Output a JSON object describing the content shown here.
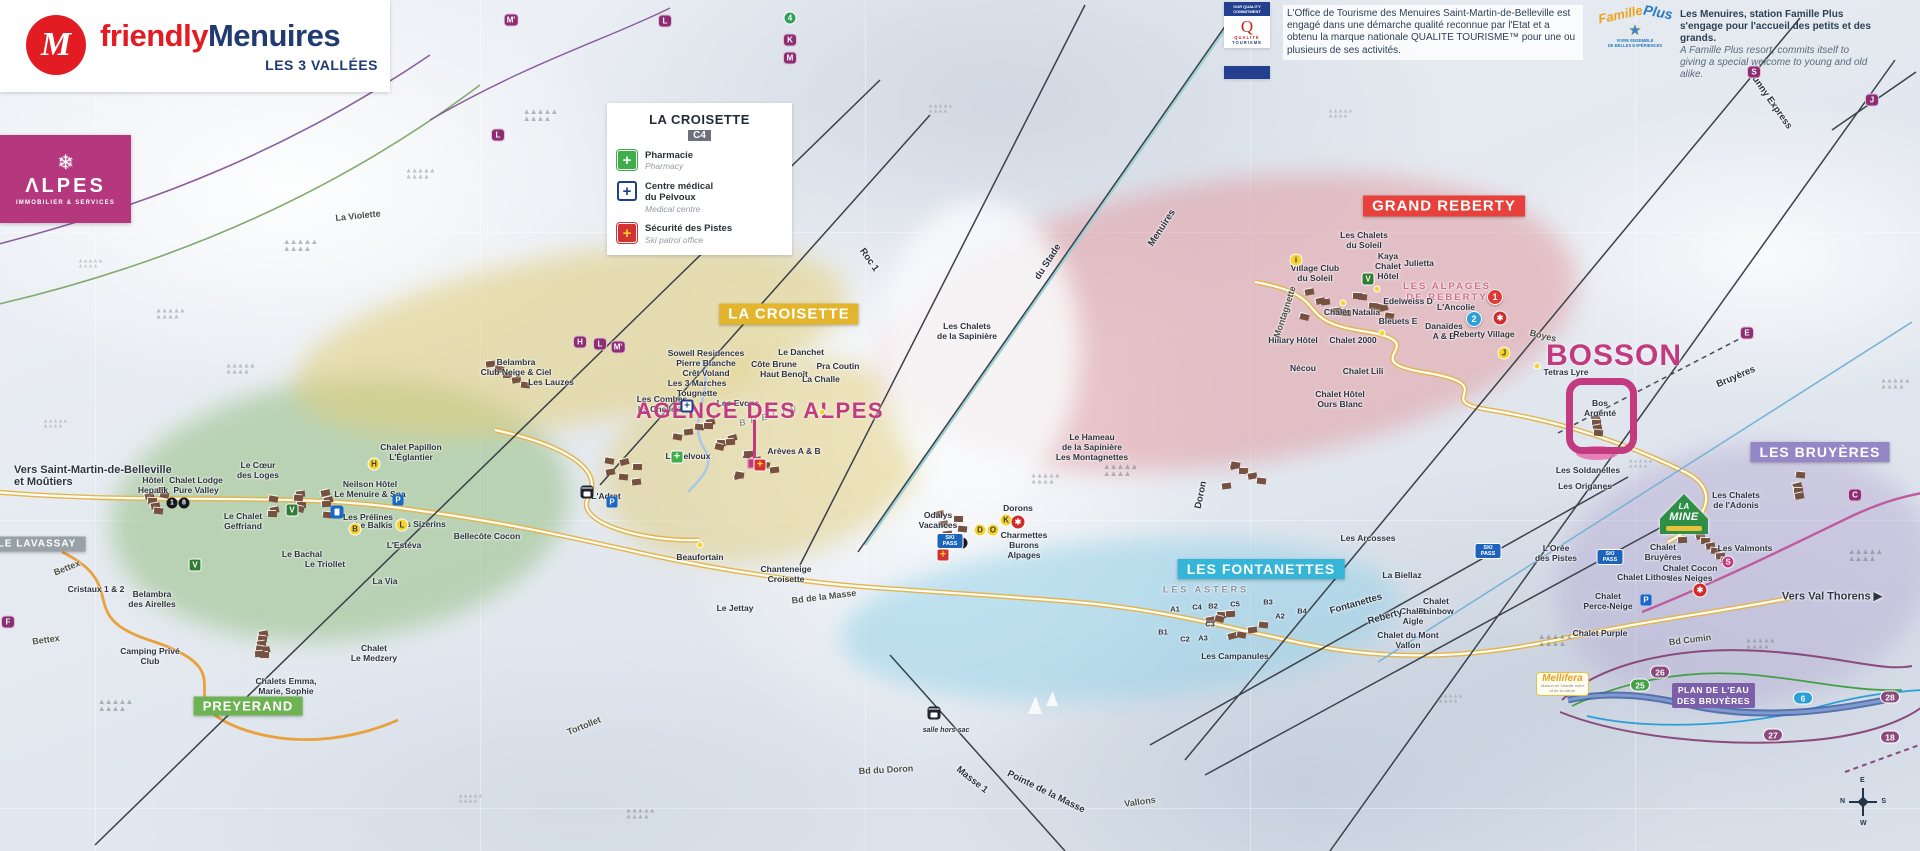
{
  "branding": {
    "monogram": "M",
    "name_a": "friendly",
    "name_b": "Menuires",
    "subtitle": "LES 3 VALLÉES",
    "alpes_flake": "❄",
    "alpes_title": "ΛLPES",
    "alpes_subtitle": "IMMOBILIER & SERVICES"
  },
  "legend": {
    "title": "LA CROISETTE",
    "code": "C4",
    "items": [
      {
        "type": "pharmacy-cross",
        "glyph": "+",
        "fr": "Pharmacie",
        "en": "Pharmacy"
      },
      {
        "type": "medical-cross",
        "glyph": "+",
        "fr": "Centre médical\ndu Pelvoux",
        "en": "Medical centre"
      },
      {
        "type": "patrol-cross",
        "glyph": "+",
        "fr": "Sécurité des Pistes",
        "en": "Ski patrol office"
      }
    ]
  },
  "quality_tourisme": {
    "banner": "OUR QUALITY COMMITMENT",
    "q": "Q",
    "brand1": "QUALITÉ",
    "brand2": "TOURISME",
    "text": "L'Office de Tourisme des Menuires Saint-Martin-de-Belleville est engagé dans une démarche qualité reconnue par l'Etat et a obtenu la marque nationale QUALITE TOURISME™ pour une ou plusieurs de ses activités."
  },
  "famille_plus": {
    "brand_a": "Famille",
    "brand_b": "Plus",
    "star": "★",
    "sub": "VIVRE ENSEMBLE\nDE BELLES EXPÉRIENCES",
    "text_fr": "Les Menuires, station Famille Plus s'engage pour l'accueil des petits et des grands.",
    "text_en": "A Famille Plus resort, commits itself to giving a special welcome to young and old alike."
  },
  "map": {
    "banners": [
      {
        "id": "croisette",
        "label": "LA CROISETTE",
        "color": "#e2b52d",
        "x": 789,
        "y": 314,
        "s": 15
      },
      {
        "id": "grand-reberty",
        "label": "GRAND REBERTY",
        "color": "#e8403a",
        "x": 1444,
        "y": 206,
        "s": 15
      },
      {
        "id": "fontanettes",
        "label": "LES FONTANETTES",
        "color": "#35b6d9",
        "x": 1261,
        "y": 569,
        "s": 14
      },
      {
        "id": "bruyeres",
        "label": "LES BRUYÈRES",
        "color": "#9387c5",
        "x": 1820,
        "y": 452,
        "s": 14
      },
      {
        "id": "preyerand",
        "label": "PREYERAND",
        "color": "#6db354",
        "x": 248,
        "y": 706,
        "s": 13
      },
      {
        "id": "lavassay",
        "label": "LE LAVASSAY",
        "color": "#99a1a8",
        "x": 37,
        "y": 544,
        "s": 10
      }
    ],
    "big_labels": [
      {
        "id": "bosson",
        "label": "BOSSON",
        "x": 1614,
        "y": 356,
        "size": 30,
        "ls": 1
      },
      {
        "id": "agence-des-alpes",
        "label": "AGENCE DES ALPES",
        "x": 760,
        "y": 411,
        "size": 22,
        "ls": 1.5
      }
    ],
    "directions": [
      {
        "t": "Vers Saint-Martin-de-Belleville\net Moûtiers",
        "x": 14,
        "y": 476,
        "a": "left"
      },
      {
        "t": "Vers Val Thorens ▶",
        "x": 1832,
        "y": 596
      }
    ],
    "places": [
      {
        "t": "Sowell Residences\nPierre Blanche\nCrêt Voland",
        "x": 706,
        "y": 363
      },
      {
        "t": "Les 3 Marches\nTougnette",
        "x": 697,
        "y": 388
      },
      {
        "t": "Les Combes\nLa Chellerie",
        "x": 662,
        "y": 404
      },
      {
        "t": "Les Evons",
        "x": 738,
        "y": 403
      },
      {
        "t": "Le Danchet",
        "x": 801,
        "y": 352
      },
      {
        "t": "Côte Brune",
        "x": 774,
        "y": 364
      },
      {
        "t": "Haut Benoît",
        "x": 784,
        "y": 374
      },
      {
        "t": "Pra Coutin",
        "x": 838,
        "y": 366
      },
      {
        "t": "La Challe",
        "x": 821,
        "y": 379
      },
      {
        "t": "Belambra\nClub Neige & Ciel",
        "x": 516,
        "y": 367
      },
      {
        "t": "Les Lauzes",
        "x": 551,
        "y": 382
      },
      {
        "t": "Chalet Papillon\nL'Églantier",
        "x": 411,
        "y": 452
      },
      {
        "t": "Neilson Hôtel\nLe Menuire & Spa",
        "x": 370,
        "y": 489
      },
      {
        "t": "Les Sizerins",
        "x": 421,
        "y": 524
      },
      {
        "t": "Bellecôte Cocon",
        "x": 487,
        "y": 536
      },
      {
        "t": "L'Adret",
        "x": 606,
        "y": 496
      },
      {
        "t": "Le Pelvoux",
        "x": 688,
        "y": 456
      },
      {
        "t": "Arèves A & B",
        "x": 794,
        "y": 451
      },
      {
        "t": "Beaufortain",
        "x": 700,
        "y": 557
      },
      {
        "t": "Le Jettay",
        "x": 735,
        "y": 608
      },
      {
        "t": "Chanteneige\nCroisette",
        "x": 786,
        "y": 574
      },
      {
        "t": "Odalys\nVacances",
        "x": 938,
        "y": 520
      },
      {
        "t": "Dorons",
        "x": 1018,
        "y": 508
      },
      {
        "t": "Charmettes\nBurons\nAlpages",
        "x": 1024,
        "y": 545
      },
      {
        "t": "Le Hameau\nde la Sapinière\nLes Montagnettes",
        "x": 1092,
        "y": 447
      },
      {
        "t": "Les Chalets\nde la Sapinière",
        "x": 967,
        "y": 331
      },
      {
        "t": "Les Chalets\ndu Soleil",
        "x": 1364,
        "y": 240
      },
      {
        "t": "Village Club\ndu Soleil",
        "x": 1315,
        "y": 273
      },
      {
        "t": "Kaya\nChalet\nHôtel",
        "x": 1388,
        "y": 266
      },
      {
        "t": "Julietta",
        "x": 1419,
        "y": 263
      },
      {
        "t": "LES ALPAGES\nDE REBERTY",
        "x": 1447,
        "y": 292,
        "c": "#d66a8e",
        "sp": 2,
        "s": 9.5
      },
      {
        "t": "Edelweiss D",
        "x": 1408,
        "y": 301
      },
      {
        "t": "L'Ancolie",
        "x": 1456,
        "y": 307
      },
      {
        "t": "Chalet Natalia",
        "x": 1352,
        "y": 312
      },
      {
        "t": "Bleuets E",
        "x": 1398,
        "y": 321
      },
      {
        "t": "Danaïdes\nA & B",
        "x": 1444,
        "y": 331
      },
      {
        "t": "Reberty Village",
        "x": 1484,
        "y": 334
      },
      {
        "t": "Chalet 2000",
        "x": 1353,
        "y": 340
      },
      {
        "t": "Hillary Hôtel",
        "x": 1293,
        "y": 340
      },
      {
        "t": "Chalet Lili",
        "x": 1363,
        "y": 371
      },
      {
        "t": "Nécou",
        "x": 1303,
        "y": 368
      },
      {
        "t": "Chalet Hôtel\nOurs Blanc",
        "x": 1340,
        "y": 399
      },
      {
        "t": "Les Soldanelles",
        "x": 1588,
        "y": 470
      },
      {
        "t": "Les Origanes",
        "x": 1585,
        "y": 486
      },
      {
        "t": "Tetras Lyre",
        "x": 1566,
        "y": 372
      },
      {
        "t": "Bos\nArgenté",
        "x": 1600,
        "y": 408
      },
      {
        "t": "Les Chalets\nde l'Adonis",
        "x": 1736,
        "y": 500
      },
      {
        "t": "Les Valmonts",
        "x": 1745,
        "y": 548
      },
      {
        "t": "Chalet\nBruyères",
        "x": 1663,
        "y": 552
      },
      {
        "t": "Chalet Cocon\ndes Neiges",
        "x": 1690,
        "y": 573
      },
      {
        "t": "Chalet Lithos",
        "x": 1644,
        "y": 577
      },
      {
        "t": "La Biellaz",
        "x": 1402,
        "y": 575
      },
      {
        "t": "Les Arcosses",
        "x": 1368,
        "y": 538
      },
      {
        "t": "Chalet\nRainbow",
        "x": 1436,
        "y": 606
      },
      {
        "t": "Chalet\nAigle",
        "x": 1413,
        "y": 616
      },
      {
        "t": "Chalet du Mont\nVallon",
        "x": 1408,
        "y": 640
      },
      {
        "t": "Chalet\nPerce-Neige",
        "x": 1608,
        "y": 601
      },
      {
        "t": "Chalet Purple",
        "x": 1600,
        "y": 633
      },
      {
        "t": "L'Orée\ndes Pistes",
        "x": 1556,
        "y": 553
      },
      {
        "t": "LES ASTERS",
        "x": 1206,
        "y": 590,
        "c": "#8a93a1",
        "sp": 3,
        "s": 9
      },
      {
        "t": "A1",
        "x": 1175,
        "y": 610,
        "s": 7.5
      },
      {
        "t": "C4",
        "x": 1197,
        "y": 608,
        "s": 7.5
      },
      {
        "t": "B2",
        "x": 1213,
        "y": 607,
        "s": 7.5
      },
      {
        "t": "C5",
        "x": 1235,
        "y": 605,
        "s": 7.5
      },
      {
        "t": "B3",
        "x": 1268,
        "y": 603,
        "s": 7.5
      },
      {
        "t": "A2",
        "x": 1280,
        "y": 617,
        "s": 7.5
      },
      {
        "t": "B4",
        "x": 1302,
        "y": 612,
        "s": 7.5
      },
      {
        "t": "C3",
        "x": 1210,
        "y": 625,
        "s": 7.5
      },
      {
        "t": "B1",
        "x": 1163,
        "y": 633,
        "s": 7.5
      },
      {
        "t": "C2",
        "x": 1185,
        "y": 640,
        "s": 7.5
      },
      {
        "t": "A3",
        "x": 1203,
        "y": 639,
        "s": 7.5
      },
      {
        "t": "Les Campanules",
        "x": 1235,
        "y": 656
      },
      {
        "t": "Le Cœur\ndes Loges",
        "x": 258,
        "y": 470
      },
      {
        "t": "Hôtel\nHepalik",
        "x": 153,
        "y": 485
      },
      {
        "t": "Chalet Lodge\nPure Valley",
        "x": 196,
        "y": 485
      },
      {
        "t": "Le Chalet\nGeffriand",
        "x": 243,
        "y": 521
      },
      {
        "t": "Le Bachal",
        "x": 302,
        "y": 554
      },
      {
        "t": "Le Triollet",
        "x": 325,
        "y": 564
      },
      {
        "t": "La Via",
        "x": 385,
        "y": 581
      },
      {
        "t": "Les Prélines",
        "x": 368,
        "y": 517
      },
      {
        "t": "Le Balkis",
        "x": 374,
        "y": 525
      },
      {
        "t": "L'Estéva",
        "x": 404,
        "y": 545
      },
      {
        "t": "Belambra\ndes Airelles",
        "x": 152,
        "y": 599
      },
      {
        "t": "Cristaux 1 & 2",
        "x": 96,
        "y": 589
      },
      {
        "t": "Camping Privé\nClub",
        "x": 150,
        "y": 656
      },
      {
        "t": "Chalet\nLe Medzery",
        "x": 374,
        "y": 653
      },
      {
        "t": "Chalets Emma,\nMarie, Sophie\n& Alice",
        "x": 286,
        "y": 691
      },
      {
        "t": "salle hors-sac",
        "x": 946,
        "y": 731,
        "s": 7,
        "i": 1
      }
    ],
    "lifts": [
      {
        "t": "Menuires",
        "x": 1162,
        "y": 228,
        "r": -57
      },
      {
        "t": "du Stade",
        "x": 1048,
        "y": 262,
        "r": -57
      },
      {
        "t": "Roc 1",
        "x": 869,
        "y": 260,
        "r": 55
      },
      {
        "t": "Sunny Express",
        "x": 1770,
        "y": 100,
        "r": 55
      },
      {
        "t": "Bruyères",
        "x": 1736,
        "y": 377,
        "r": -23
      },
      {
        "t": "Fontanettes",
        "x": 1356,
        "y": 604,
        "r": -16
      },
      {
        "t": "Reberty",
        "x": 1385,
        "y": 617,
        "r": -16
      },
      {
        "t": "Masse 1",
        "x": 972,
        "y": 780,
        "r": 38
      },
      {
        "t": "Pointe de la Masse",
        "x": 1046,
        "y": 792,
        "r": 26
      },
      {
        "t": "Doron",
        "x": 1201,
        "y": 495,
        "r": -78
      }
    ],
    "roads": [
      {
        "t": "La Violette",
        "x": 358,
        "y": 216,
        "r": -6
      },
      {
        "t": "Bettex",
        "x": 67,
        "y": 568,
        "r": -22
      },
      {
        "t": "Bettex",
        "x": 46,
        "y": 640,
        "r": -8
      },
      {
        "t": "BRELIN",
        "x": 770,
        "y": 416,
        "r": -14,
        "sp": 5,
        "c": "#8f9384",
        "i": 1
      },
      {
        "t": "Montagnette",
        "x": 1285,
        "y": 312,
        "r": -72
      },
      {
        "t": "Boyes",
        "x": 1543,
        "y": 336,
        "r": 14
      },
      {
        "t": "Bd de la Masse",
        "x": 824,
        "y": 597,
        "r": -7
      },
      {
        "t": "Tortollet",
        "x": 584,
        "y": 726,
        "r": -22
      },
      {
        "t": "Bd du Doron",
        "x": 886,
        "y": 770,
        "r": -3
      },
      {
        "t": "Vallons",
        "x": 1140,
        "y": 802,
        "r": -8
      },
      {
        "t": "Bd Cumin",
        "x": 1690,
        "y": 640,
        "r": -7
      }
    ],
    "badges": [
      {
        "k": "pill",
        "t": "M'",
        "x": 511,
        "y": 20
      },
      {
        "k": "pill",
        "t": "L",
        "x": 665,
        "y": 21
      },
      {
        "k": "gcircle",
        "t": "4",
        "x": 790,
        "y": 18
      },
      {
        "k": "pill",
        "t": "K",
        "x": 790,
        "y": 40
      },
      {
        "k": "pill",
        "t": "M",
        "x": 790,
        "y": 58
      },
      {
        "k": "pill",
        "t": "L",
        "x": 498,
        "y": 135
      },
      {
        "k": "pill",
        "t": "H",
        "x": 580,
        "y": 342
      },
      {
        "k": "pill",
        "t": "L",
        "x": 600,
        "y": 344
      },
      {
        "k": "pill",
        "t": "M'",
        "x": 618,
        "y": 347
      },
      {
        "k": "pill",
        "t": "E",
        "x": 1747,
        "y": 333
      },
      {
        "k": "pill",
        "t": "J",
        "x": 1872,
        "y": 100
      },
      {
        "k": "pill",
        "t": "S",
        "x": 1754,
        "y": 72
      },
      {
        "k": "pill",
        "t": "F",
        "x": 8,
        "y": 622
      },
      {
        "k": "pill",
        "t": "C",
        "x": 1855,
        "y": 495
      },
      {
        "k": "ycircle",
        "t": "D",
        "x": 980,
        "y": 530
      },
      {
        "k": "ycircle",
        "t": "O",
        "x": 993,
        "y": 530
      },
      {
        "k": "ycircle",
        "t": "K",
        "x": 1006,
        "y": 520
      },
      {
        "k": "ycircle",
        "t": "H",
        "x": 374,
        "y": 464
      },
      {
        "k": "ycircle",
        "t": "B",
        "x": 355,
        "y": 529
      },
      {
        "k": "ycircle",
        "t": "L",
        "x": 402,
        "y": 525
      },
      {
        "k": "ycircle",
        "t": "J",
        "x": 1504,
        "y": 353
      },
      {
        "k": "ycircle",
        "t": "i",
        "x": 1296,
        "y": 260
      },
      {
        "k": "kcircle",
        "t": "1",
        "x": 172,
        "y": 503
      },
      {
        "k": "kcircle",
        "t": "8",
        "x": 184,
        "y": 503
      },
      {
        "k": "kcircle",
        "t": "3",
        "x": 962,
        "y": 543
      },
      {
        "k": "rcircle",
        "t": "1",
        "x": 1495,
        "y": 297
      },
      {
        "k": "bcircle",
        "t": "2",
        "x": 1474,
        "y": 319
      },
      {
        "k": "route",
        "t": "26",
        "x": 1660,
        "y": 672,
        "c": "#8b4a7d"
      },
      {
        "k": "route",
        "t": "27",
        "x": 1773,
        "y": 735,
        "c": "#8b4a7d"
      },
      {
        "k": "route",
        "t": "28",
        "x": 1890,
        "y": 697,
        "c": "#8b4a7d"
      },
      {
        "k": "route",
        "t": "18",
        "x": 1890,
        "y": 737,
        "c": "#8b4a7d"
      },
      {
        "k": "route",
        "t": "25",
        "x": 1640,
        "y": 685,
        "c": "#43a047"
      },
      {
        "k": "route",
        "t": "6",
        "x": 1803,
        "y": 698,
        "c": "#2a9fd8"
      },
      {
        "k": "skipass",
        "t": "SKI\nPASS",
        "x": 950,
        "y": 541
      },
      {
        "k": "skipass",
        "t": "SKI\nPASS",
        "x": 1488,
        "y": 551
      },
      {
        "k": "skipass",
        "t": "SKI\nPASS",
        "x": 1610,
        "y": 557
      },
      {
        "k": "greenv",
        "t": "V",
        "x": 1368,
        "y": 279
      },
      {
        "k": "greenv",
        "t": "V",
        "x": 292,
        "y": 510
      },
      {
        "k": "greenv",
        "t": "V",
        "x": 195,
        "y": 565
      },
      {
        "k": "parking",
        "t": "P",
        "x": 612,
        "y": 502
      },
      {
        "k": "parking",
        "t": "P",
        "x": 398,
        "y": 500
      },
      {
        "k": "parking",
        "t": "P",
        "x": 1646,
        "y": 600
      },
      {
        "k": "fuel",
        "t": "",
        "x": 337,
        "y": 512
      },
      {
        "k": "crossg",
        "t": "+",
        "x": 677,
        "y": 457
      },
      {
        "k": "crossb",
        "t": "+",
        "x": 687,
        "y": 406
      },
      {
        "k": "crossp",
        "t": "+",
        "x": 943,
        "y": 555
      },
      {
        "k": "crossp",
        "t": "+",
        "x": 760,
        "y": 465
      },
      {
        "k": "gondola",
        "t": "",
        "x": 587,
        "y": 492
      },
      {
        "k": "gondola",
        "t": "",
        "x": 934,
        "y": 713
      },
      {
        "k": "dot",
        "t": "",
        "x": 1377,
        "y": 289
      },
      {
        "k": "dot",
        "t": "",
        "x": 1343,
        "y": 303
      },
      {
        "k": "dot",
        "t": "",
        "x": 1382,
        "y": 333
      },
      {
        "k": "dot",
        "t": "",
        "x": 1537,
        "y": 366
      },
      {
        "k": "dot",
        "t": "",
        "x": 822,
        "y": 412
      },
      {
        "k": "dot",
        "t": "",
        "x": 700,
        "y": 545
      },
      {
        "k": "mcircle",
        "t": "S",
        "x": 1728,
        "y": 562
      },
      {
        "k": "rlogo",
        "t": "✱",
        "x": 1500,
        "y": 318
      },
      {
        "k": "rlogo",
        "t": "✱",
        "x": 1018,
        "y": 522
      },
      {
        "k": "rlogo",
        "t": "✱",
        "x": 1700,
        "y": 590
      }
    ],
    "special": {
      "plan_eau": "PLAN DE L'EAU\nDES BRUYÈRES",
      "mellifera_title": "Mellifera",
      "mellifera_sub": "Maison de l'abeille noire\net de la nature",
      "lamine_a": "LA",
      "lamine_b": "MINE",
      "compass": {
        "n": "N",
        "e": "E",
        "s": "S",
        "w": "W"
      }
    }
  }
}
